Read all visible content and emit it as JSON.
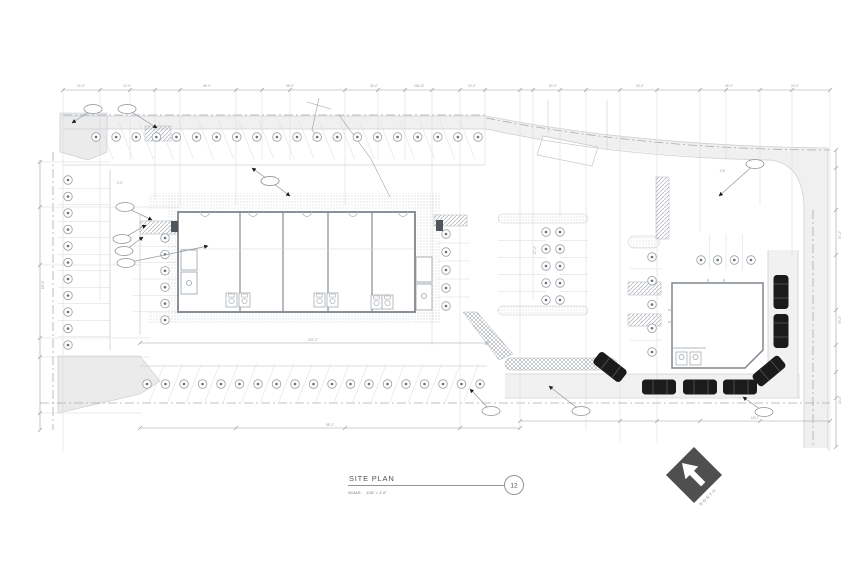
{
  "drawing": {
    "title": "SITE PLAN",
    "scale_label": "SCALE:",
    "scale_value": "1/16\" = 1'-0\"",
    "detail_number": "12",
    "north_label": "NORTH"
  },
  "colors": {
    "background": "#ffffff",
    "line_light": "#d5d8db",
    "line_medium": "#b0b5ba",
    "line_dark": "#8f959b",
    "wall": "#7f858c",
    "text_dim": "#9aa0a6",
    "text_dark": "#4f545a",
    "car_fill": "#1b1b1b",
    "north_diamond": "#4f4f4f",
    "pavement": "#f0f0f1",
    "landscape_fill": "#ebebec"
  },
  "parking": {
    "marker_style": "circle-with-dot",
    "rows": [
      {
        "name": "north-angled-row",
        "type": "row",
        "y": 137,
        "x_start": 96,
        "x_end": 478,
        "count": 20,
        "stall": "angled-down"
      },
      {
        "name": "south-angled-row",
        "type": "row",
        "y": 384,
        "x_start": 147,
        "x_end": 480,
        "count": 19,
        "stall": "angled-up"
      },
      {
        "name": "west-outer-column",
        "type": "col",
        "x": 68,
        "y_start": 180,
        "y_end": 345,
        "count": 11,
        "dx1": -10,
        "dx2": 42
      },
      {
        "name": "west-inner-column",
        "type": "col",
        "x": 165,
        "y_start": 238,
        "y_end": 320,
        "count": 6,
        "dx1": -32,
        "dx2": 18
      },
      {
        "name": "center-column",
        "type": "col",
        "x": 446,
        "y_start": 234,
        "y_end": 306,
        "count": 5,
        "dx1": -9,
        "dx2": 24
      },
      {
        "name": "middle-double-west",
        "type": "col",
        "x": 546,
        "y_start": 232,
        "y_end": 300,
        "count": 5,
        "dx1": -48,
        "dx2": 0
      },
      {
        "name": "middle-double-east",
        "type": "col",
        "x": 560,
        "y_start": 232,
        "y_end": 300,
        "count": 5,
        "dx1": 0,
        "dx2": 28
      },
      {
        "name": "east-column",
        "type": "col",
        "x": 652,
        "y_start": 257,
        "y_end": 352,
        "count": 5,
        "dx1": -22,
        "dx2": 10
      },
      {
        "name": "northeast-row",
        "type": "row",
        "y": 260,
        "x_start": 701,
        "x_end": 751,
        "count": 4,
        "stall": "vertical"
      }
    ]
  },
  "vehicles": [
    {
      "x": 610,
      "y": 367,
      "rotation": 38
    },
    {
      "x": 659,
      "y": 387,
      "rotation": 0
    },
    {
      "x": 700,
      "y": 387,
      "rotation": 0
    },
    {
      "x": 740,
      "y": 387,
      "rotation": 0
    },
    {
      "x": 769,
      "y": 371,
      "rotation": -40
    },
    {
      "x": 781,
      "y": 331,
      "rotation": -90
    },
    {
      "x": 781,
      "y": 292,
      "rotation": -90
    }
  ],
  "callouts": [
    {
      "ex": 93,
      "ey": 109,
      "ax": 72,
      "ay": 123
    },
    {
      "ex": 127,
      "ey": 109,
      "ax": 157,
      "ay": 128
    },
    {
      "ex": 125,
      "ey": 207,
      "ax": 152,
      "ay": 220
    },
    {
      "ex": 122,
      "ey": 239,
      "ax": 146,
      "ay": 225
    },
    {
      "ex": 124,
      "ey": 251,
      "ax": 143,
      "ay": 237
    },
    {
      "ex": 126,
      "ey": 263,
      "ax": 208,
      "ay": 246
    },
    {
      "ex": 270,
      "ey": 181,
      "ax": 252,
      "ay": 168
    },
    {
      "ex": 270,
      "ey": 181,
      "ax": 290,
      "ay": 196
    },
    {
      "ex": 755,
      "ey": 164,
      "ax": 719,
      "ay": 196
    },
    {
      "ex": 491,
      "ey": 411,
      "ax": 470,
      "ay": 389
    },
    {
      "ex": 581,
      "ey": 411,
      "ax": 549,
      "ay": 386
    },
    {
      "ex": 764,
      "ey": 412,
      "ax": 743,
      "ay": 397
    }
  ],
  "dim_labels": [
    {
      "x": 81,
      "y": 87,
      "t": "15'-0\""
    },
    {
      "x": 127,
      "y": 87,
      "t": "12'-0\""
    },
    {
      "x": 207,
      "y": 87,
      "t": "58'-0\""
    },
    {
      "x": 290,
      "y": 87,
      "t": "36'-0\""
    },
    {
      "x": 374,
      "y": 87,
      "t": "30'-0\""
    },
    {
      "x": 419,
      "y": 87,
      "t": "236.33'"
    },
    {
      "x": 472,
      "y": 87,
      "t": "24'-0\""
    },
    {
      "x": 553,
      "y": 87,
      "t": "60'-0\""
    },
    {
      "x": 640,
      "y": 87,
      "t": "35'-0\""
    },
    {
      "x": 729,
      "y": 87,
      "t": "48'-0\""
    },
    {
      "x": 795,
      "y": 87,
      "t": "20'-0\""
    },
    {
      "x": 44,
      "y": 285,
      "t": "165.6'",
      "rot": -90
    },
    {
      "x": 120,
      "y": 184,
      "t": "5'-0\""
    },
    {
      "x": 313,
      "y": 341,
      "t": "202'-0\""
    },
    {
      "x": 330,
      "y": 426,
      "t": "95'-2\""
    },
    {
      "x": 755,
      "y": 419,
      "t": "142.7'"
    },
    {
      "x": 536,
      "y": 250,
      "t": "27'-2\"",
      "rot": -90
    },
    {
      "x": 722,
      "y": 172,
      "t": "178"
    },
    {
      "x": 841,
      "y": 235,
      "t": "57'-2\"",
      "rot": -90
    },
    {
      "x": 841,
      "y": 320,
      "t": "35'-0\"",
      "rot": -90
    },
    {
      "x": 841,
      "y": 400,
      "t": "24'-0\"",
      "rot": -90
    }
  ]
}
